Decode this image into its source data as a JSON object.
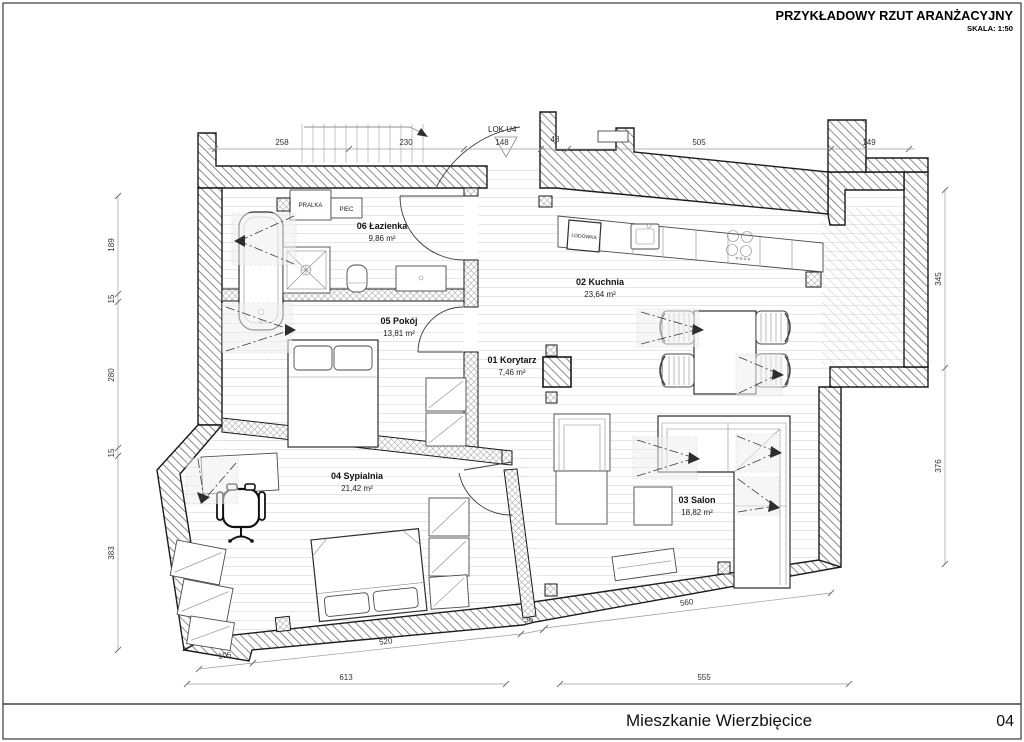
{
  "title_block": {
    "title": "PRZYKŁADOWY RZUT ARANŻACYJNY",
    "scale": "SKALA: 1:50"
  },
  "plan": {
    "unit": "LOK U4"
  },
  "rooms": [
    {
      "label": "01 Korytarz",
      "area": "7,46 m²"
    },
    {
      "label": "02 Kuchnia",
      "area": "23,64 m²"
    },
    {
      "label": "03 Salon",
      "area": "18,82 m²"
    },
    {
      "label": "04 Sypialnia",
      "area": "21,42 m²"
    },
    {
      "label": "05 Pokój",
      "area": "13,81 m²"
    },
    {
      "label": "06 Łazienka",
      "area": "9,86 m²"
    }
  ],
  "labels": {
    "washer": "PRALKA",
    "stove": "PIEC",
    "fridge": "LODÓWKA"
  },
  "dims": {
    "top": [
      "258",
      "230",
      "148",
      "48",
      "505",
      "149"
    ],
    "left": [
      "189",
      "15",
      "280",
      "15",
      "383"
    ],
    "right": [
      "345",
      "376"
    ],
    "bottom": [
      "560",
      "36",
      "520",
      "105",
      "613",
      "555"
    ]
  },
  "footer": {
    "project": "Mieszkanie Wierzbięcice",
    "page": "04"
  },
  "colors": {
    "wall_line": "#1b1b1b",
    "dim_line": "#9a9a9a",
    "text": "#111111"
  }
}
